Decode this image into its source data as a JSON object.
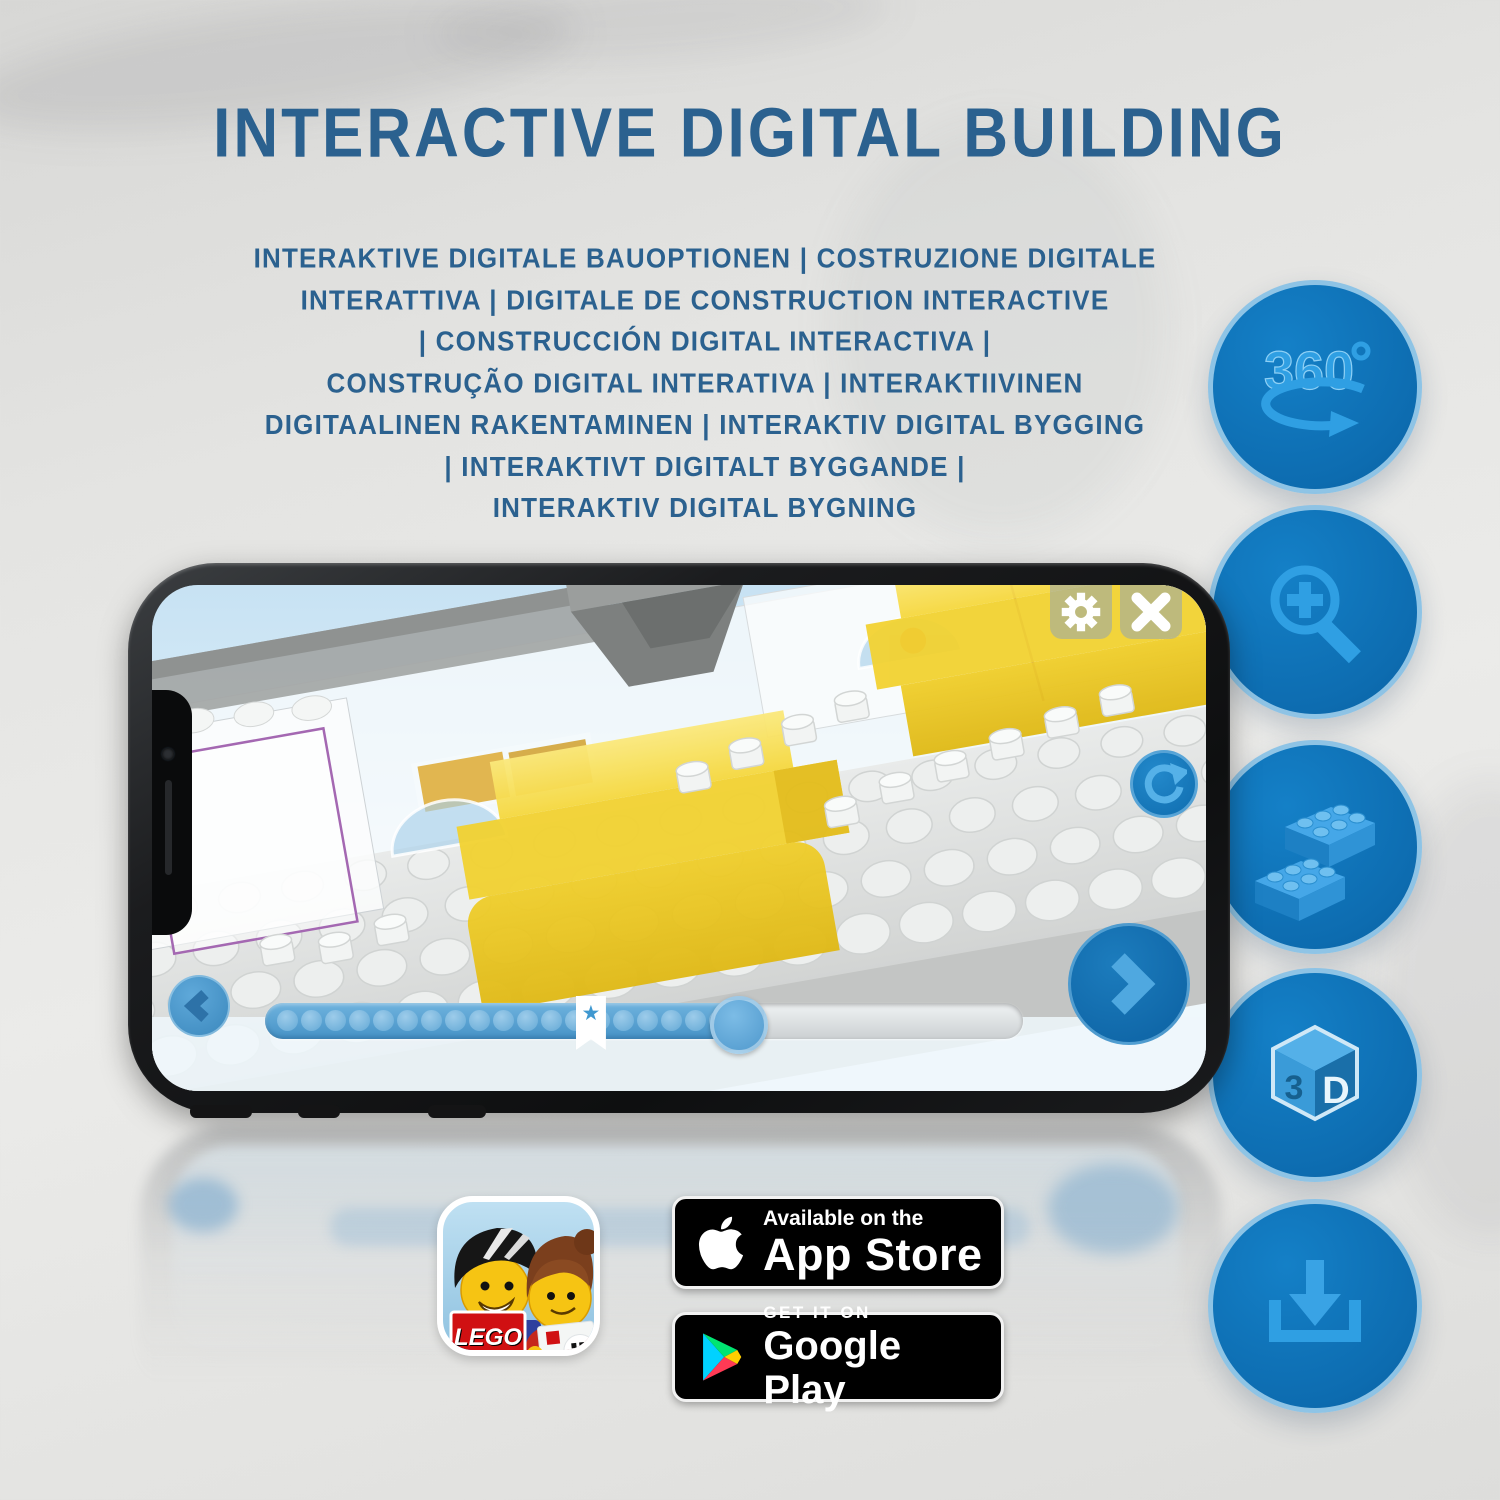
{
  "page": {
    "title": "INTERACTIVE DIGITAL BUILDING"
  },
  "subtitle": {
    "lines": [
      "INTERAKTIVE DIGITALE BAUOPTIONEN | COSTRUZIONE DIGITALE",
      "INTERATTIVA | DIGITALE DE CONSTRUCTION INTERACTIVE",
      "| CONSTRUCCIÓN DIGITAL INTERACTIVA |",
      "CONSTRUÇÃO DIGITAL INTERATIVA | INTERAKTIIVINEN",
      "DIGITAALINEN RAKENTAMINEN | INTERAKTIV DIGITAL BYGGING",
      "| INTERAKTIVT DIGITALT BYGGANDE |",
      "INTERAKTIV DIGITAL BYGNING"
    ]
  },
  "features": [
    {
      "icon": "360-rotation-icon",
      "glyph_text": "360"
    },
    {
      "icon": "zoom-in-icon"
    },
    {
      "icon": "brick-stacking-icon"
    },
    {
      "icon": "3d-view-icon",
      "face_left": "3",
      "face_right": "D"
    },
    {
      "icon": "download-instructions-icon"
    }
  ],
  "phone_app": {
    "hud": {
      "settings_icon": "gear-icon",
      "close_icon": "close-icon",
      "rotate_icon": "rotate-reset-icon",
      "back_icon": "chevron-left-icon",
      "next_icon": "chevron-right-icon"
    },
    "progress": {
      "dot_count": 20,
      "bookmark_pct": 43,
      "handle_pct": 62
    },
    "scene_description": "3D LEGO building step with highlighted yellow bricks"
  },
  "badges": {
    "app_store": {
      "line1": "Available on the",
      "line2": "App Store"
    },
    "google_play": {
      "line1": "GET IT ON",
      "line2": "Google Play"
    },
    "app_icon": {
      "logo_text": "LEGO"
    }
  },
  "colors": {
    "title_blue": "#2b618f",
    "feature_circle_blue": "#0d6cb0",
    "feature_glyph_blue": "#2f9fe3",
    "highlight_yellow": "#f2d231",
    "screen_sky": "#cde5f4"
  }
}
